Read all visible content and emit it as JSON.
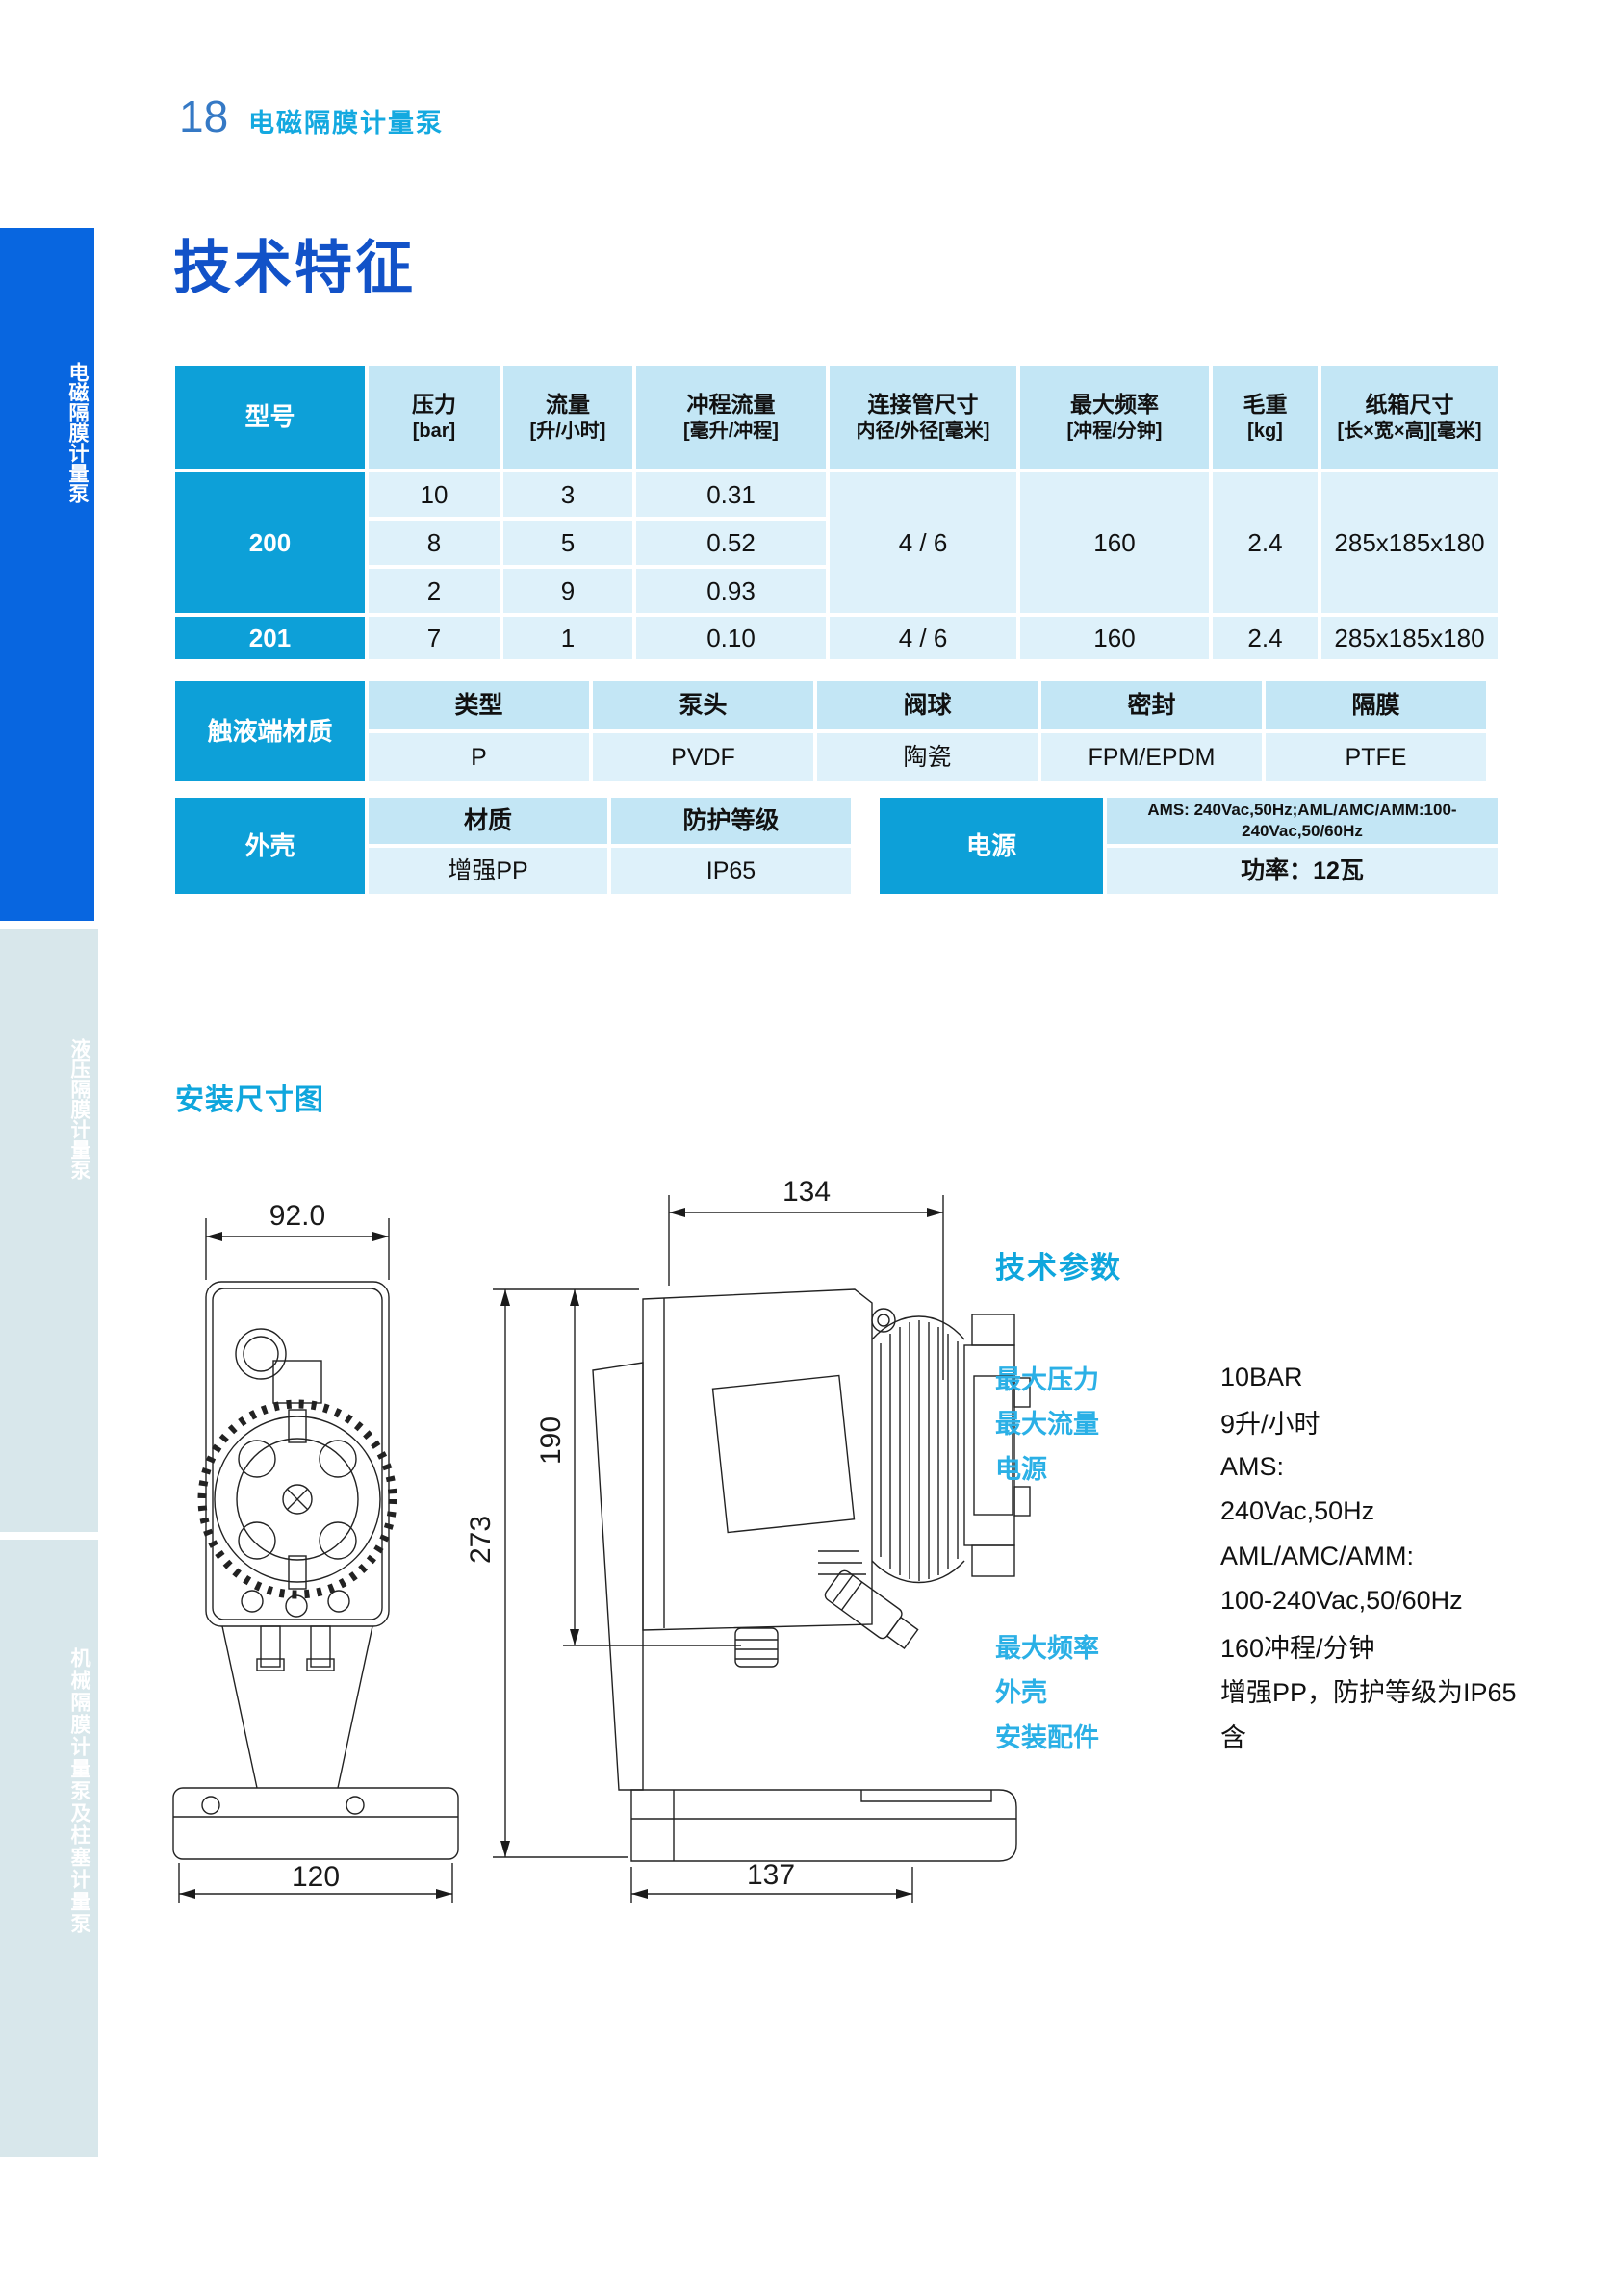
{
  "colors": {
    "accent_blue": "#1252c8",
    "cyan_heading": "#0fa6dd",
    "table_dark_cell": "#0da0d8",
    "table_header_bg": "#c3e6f5",
    "table_value_bg": "#def1fa",
    "sidebar_active_bg": "#0866e0",
    "sidebar_inactive_bg": "#d8e7eb"
  },
  "page": {
    "number": "18",
    "header_title": "电磁隔膜计量泵",
    "section_title": "技术特征"
  },
  "sidebar": {
    "tabs": [
      {
        "label": "电磁隔膜计量泵"
      },
      {
        "label": "液压隔膜计量泵"
      },
      {
        "label": "机械隔膜计量泵及柱塞计量泵"
      }
    ]
  },
  "spec_table": {
    "headers": [
      {
        "line1": "型号",
        "line2": ""
      },
      {
        "line1": "压力",
        "line2": "[bar]"
      },
      {
        "line1": "流量",
        "line2": "[升/小时]"
      },
      {
        "line1": "冲程流量",
        "line2": "[毫升/冲程]"
      },
      {
        "line1": "连接管尺寸",
        "line2": "内径/外径[毫米]"
      },
      {
        "line1": "最大频率",
        "line2": "[冲程/分钟]"
      },
      {
        "line1": "毛重",
        "line2": "[kg]"
      },
      {
        "line1": "纸箱尺寸",
        "line2": "[长×宽×高][毫米]"
      }
    ],
    "models": [
      {
        "model": "200",
        "rows": [
          {
            "pressure": "10",
            "flow": "3",
            "stroke_volume": "0.31"
          },
          {
            "pressure": "8",
            "flow": "5",
            "stroke_volume": "0.52"
          },
          {
            "pressure": "2",
            "flow": "9",
            "stroke_volume": "0.93"
          }
        ],
        "pipe_size": "4 / 6",
        "max_frequency": "160",
        "gross_weight": "2.4",
        "carton_size": "285x185x180"
      },
      {
        "model": "201",
        "rows": [
          {
            "pressure": "7",
            "flow": "1",
            "stroke_volume": "0.10"
          }
        ],
        "pipe_size": "4 / 6",
        "max_frequency": "160",
        "gross_weight": "2.4",
        "carton_size": "285x185x180"
      }
    ]
  },
  "material_table": {
    "label": "触液端材质",
    "headers": [
      "类型",
      "泵头",
      "阀球",
      "密封",
      "隔膜"
    ],
    "values": [
      "P",
      "PVDF",
      "陶瓷",
      "FPM/EPDM",
      "PTFE"
    ]
  },
  "housing_table": {
    "label": "外壳",
    "headers": [
      "材质",
      "防护等级"
    ],
    "values": [
      "增强PP",
      "IP65"
    ]
  },
  "power_table": {
    "label": "电源",
    "line1": "AMS: 240Vac,50Hz;AML/AMC/AMM:100-240Vac,50/60Hz",
    "line2": "功率：12瓦"
  },
  "installation": {
    "section_title": "安装尺寸图",
    "front_view": {
      "top_width": "92.0",
      "base_width": "120"
    },
    "side_view": {
      "top_width": "134",
      "total_height": "273",
      "body_height": "190",
      "base_width": "137"
    }
  },
  "tech_params": {
    "title": "技术参数",
    "rows": [
      {
        "label": "最大压力",
        "value": "10BAR"
      },
      {
        "label": "最大流量",
        "value": "9升/小时"
      },
      {
        "label": "电源",
        "value": "AMS:"
      },
      {
        "label": "",
        "value": "240Vac,50Hz"
      },
      {
        "label": "",
        "value": "AML/AMC/AMM:"
      },
      {
        "label": "",
        "value": "100-240Vac,50/60Hz"
      },
      {
        "label": "最大频率",
        "value": "160冲程/分钟"
      },
      {
        "label": "外壳",
        "value": "增强PP，防护等级为IP65"
      },
      {
        "label": "安装配件",
        "value": "含"
      }
    ]
  }
}
